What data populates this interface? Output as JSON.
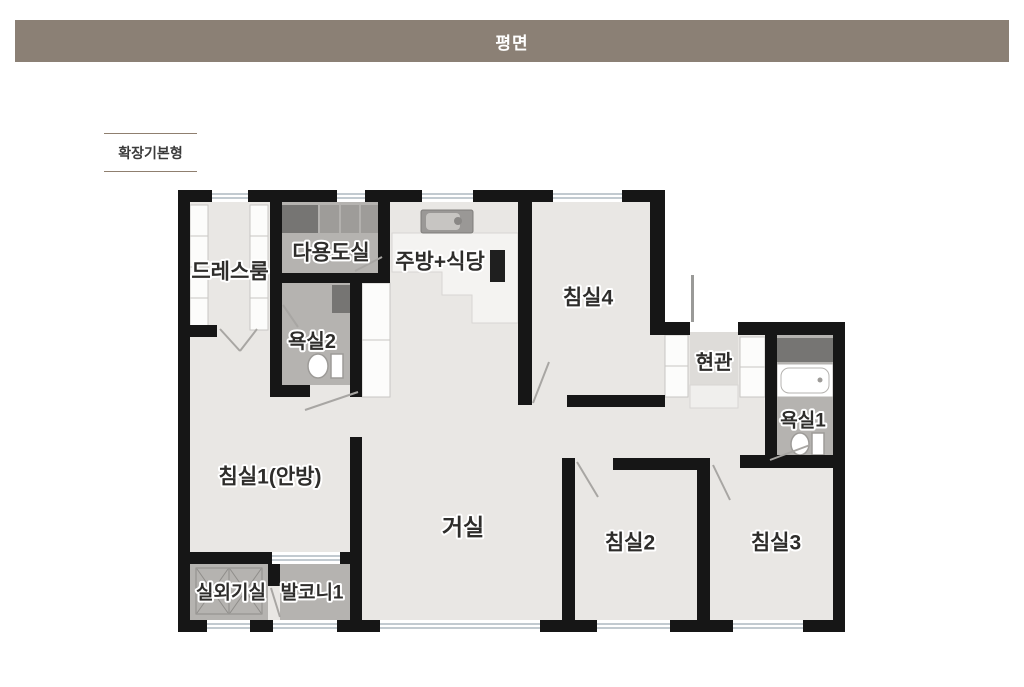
{
  "header": {
    "title": "평면"
  },
  "plan_type": {
    "label": "확장기본형"
  },
  "colors": {
    "header_bg": "#8b8075",
    "header_text": "#ffffff",
    "page_bg": "#ffffff",
    "wall": "#161616",
    "floor": "#e9e7e4",
    "wet_floor": "#b5b3b0",
    "dark_cabinet": "#767573",
    "counter": "#f4f3f1",
    "closet_white": "#fcfcfb",
    "window_line": "#aeb8c0",
    "door_swing": "#a8a6a3",
    "label_text": "#2e2d2b",
    "type_border": "#8f7f6f"
  },
  "floorplan": {
    "rooms": [
      {
        "id": "dressroom",
        "label": "드레스룸",
        "x": 230,
        "y": 272,
        "size": 21
      },
      {
        "id": "utility",
        "label": "다용도실",
        "x": 331,
        "y": 253,
        "size": 21
      },
      {
        "id": "kitchen",
        "label": "주방+식당",
        "x": 440,
        "y": 262,
        "size": 21
      },
      {
        "id": "bedroom4",
        "label": "침실4",
        "x": 588,
        "y": 298,
        "size": 21
      },
      {
        "id": "bathroom2",
        "label": "욕실2",
        "x": 312,
        "y": 342,
        "size": 20
      },
      {
        "id": "entrance",
        "label": "현관",
        "x": 714,
        "y": 363,
        "size": 20
      },
      {
        "id": "bathroom1",
        "label": "욕실1",
        "x": 803,
        "y": 421,
        "size": 19
      },
      {
        "id": "bedroom1",
        "label": "침실1(안방)",
        "x": 270,
        "y": 477,
        "size": 21
      },
      {
        "id": "living",
        "label": "거실",
        "x": 463,
        "y": 527,
        "size": 23
      },
      {
        "id": "bedroom2",
        "label": "침실2",
        "x": 630,
        "y": 543,
        "size": 21
      },
      {
        "id": "bedroom3",
        "label": "침실3",
        "x": 776,
        "y": 543,
        "size": 21
      },
      {
        "id": "outdoor-unit",
        "label": "실외기실",
        "x": 231,
        "y": 593,
        "size": 19
      },
      {
        "id": "balcony1",
        "label": "발코니1",
        "x": 312,
        "y": 593,
        "size": 19
      }
    ]
  }
}
